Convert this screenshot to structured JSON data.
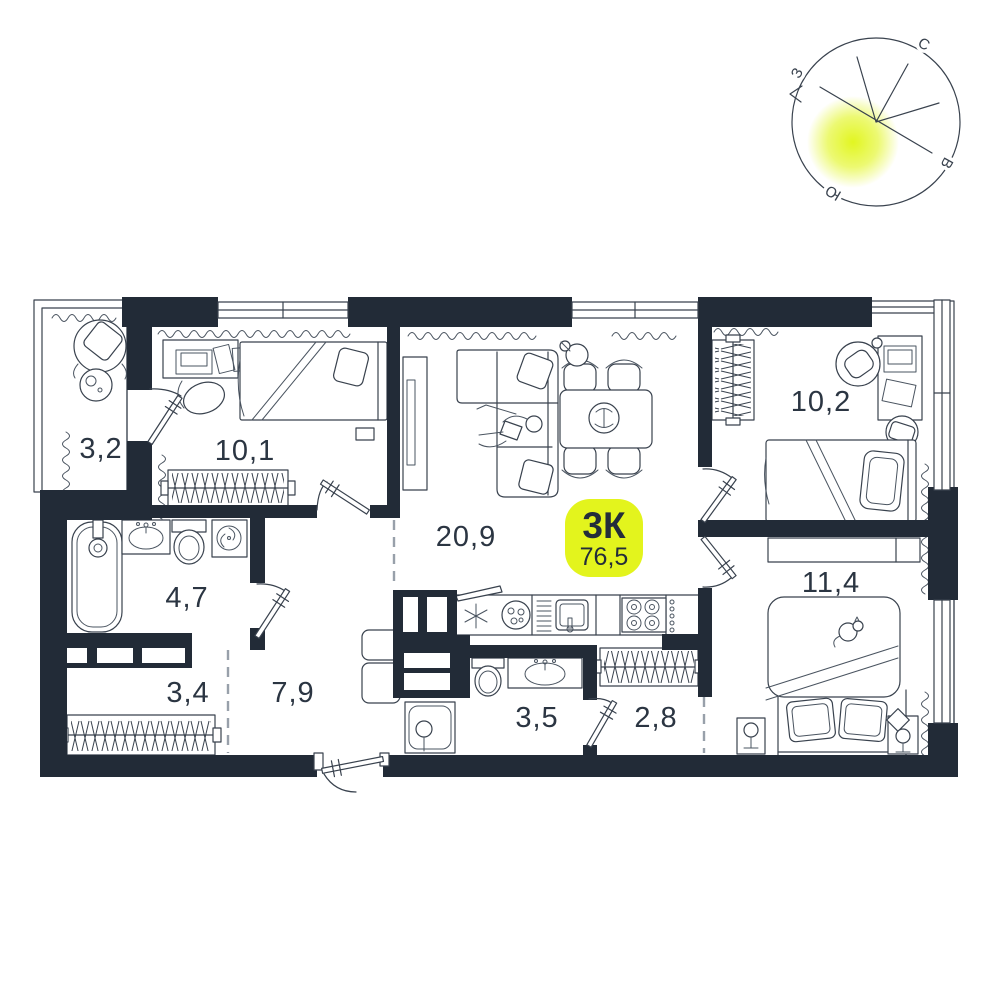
{
  "floorplan": {
    "badge": {
      "type": "3К",
      "area": "76,5"
    },
    "rooms": [
      {
        "name": "balcony",
        "area": "3,2"
      },
      {
        "name": "bedroom-1",
        "area": "10,1"
      },
      {
        "name": "living-room-kitchen",
        "area": "20,9"
      },
      {
        "name": "bedroom-2",
        "area": "10,2"
      },
      {
        "name": "bedroom-3",
        "area": "11,4"
      },
      {
        "name": "bathroom",
        "area": "4,7"
      },
      {
        "name": "storage",
        "area": "3,4"
      },
      {
        "name": "hallway",
        "area": "7,9"
      },
      {
        "name": "shower-room",
        "area": "3,5"
      },
      {
        "name": "wardrobe",
        "area": "2,8"
      }
    ],
    "compass": {
      "north": "С",
      "east": "В",
      "south": "Ю",
      "west": "З"
    },
    "colors": {
      "wall": "#222b37",
      "accent": "#e3f41d",
      "ink": "#2b3542"
    }
  }
}
